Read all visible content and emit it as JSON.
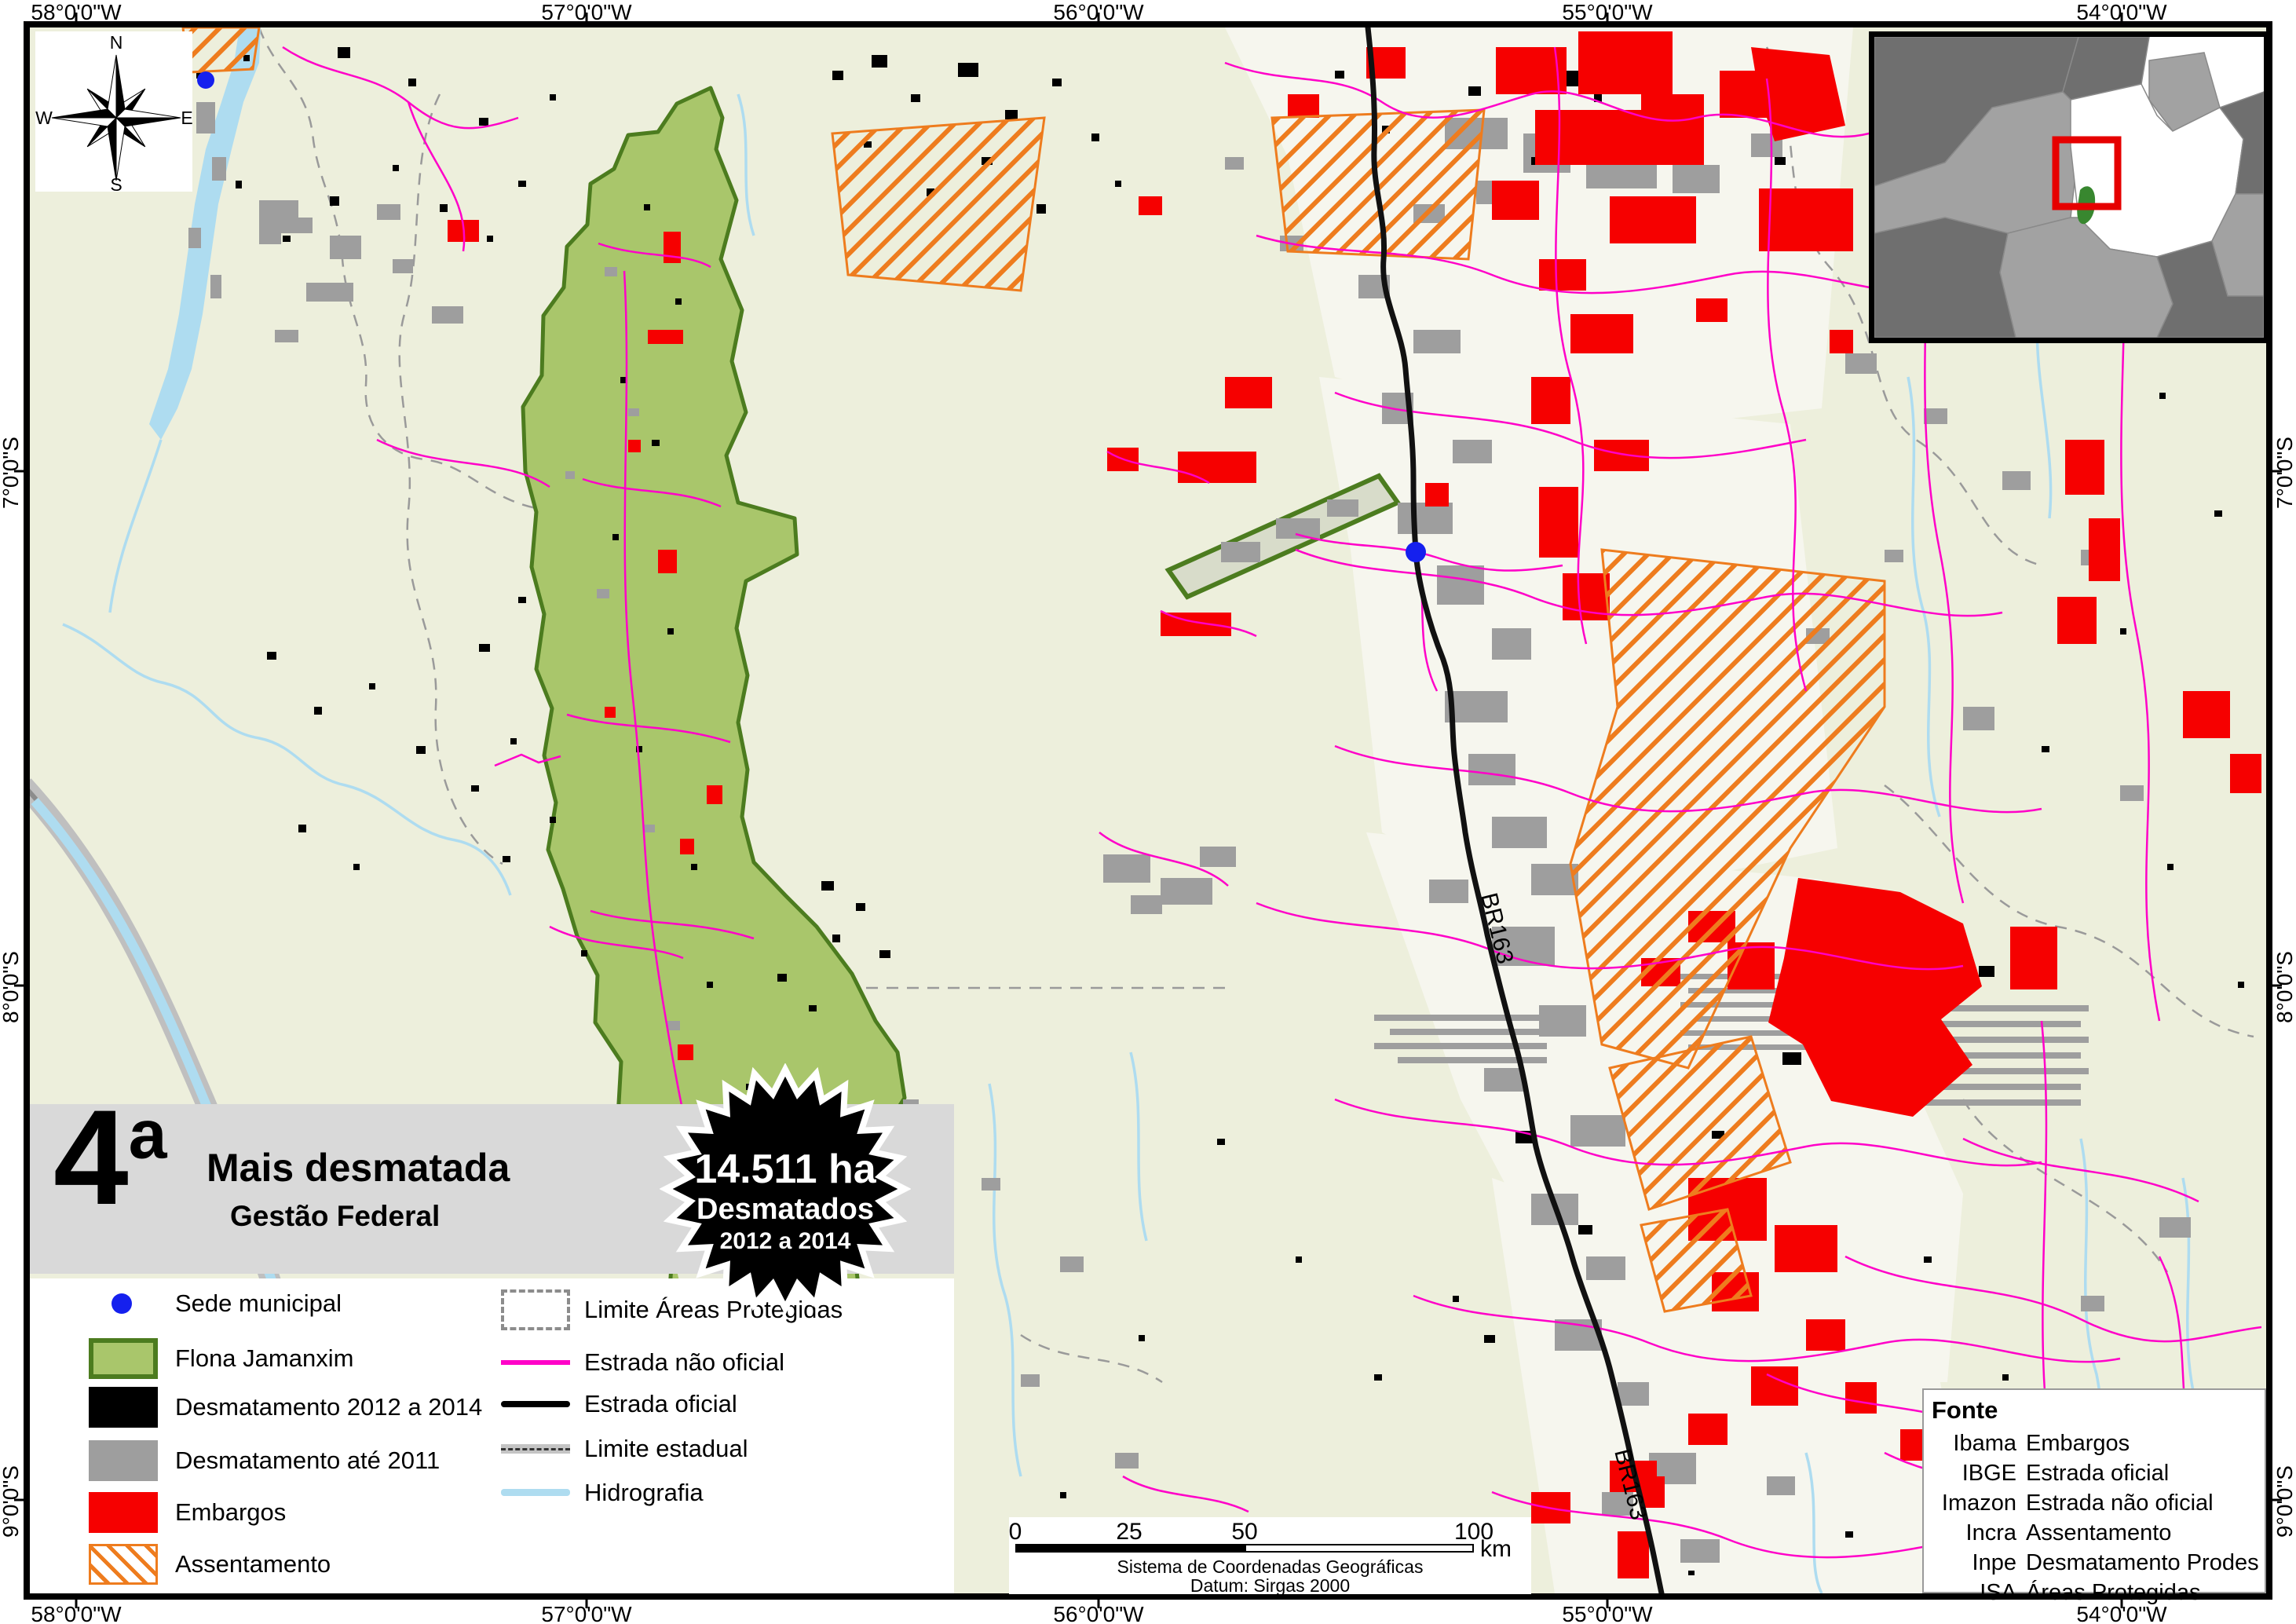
{
  "map": {
    "title_block": {
      "rank": "4",
      "rank_suffix": "a",
      "title": "Mais desmatada",
      "subtitle": "Gestão Federal"
    },
    "badge": {
      "line1": "14.511 ha",
      "line2": "Desmatados",
      "line3": "2012 a 2014"
    },
    "axis": {
      "top": [
        "58°0'0\"W",
        "57°0'0\"W",
        "56°0'0\"W",
        "55°0'0\"W",
        "54°0'0\"W"
      ],
      "bottom": [
        "58°0'0\"W",
        "57°0'0\"W",
        "56°0'0\"W",
        "55°0'0\"W",
        "54°0'0\"W"
      ],
      "left": [
        "7°0'0\"S",
        "8°0'0\"S",
        "9°0'0\"S"
      ],
      "right": [
        "7°0'0\"S",
        "8°0'0\"S",
        "9°0'0\"S"
      ]
    },
    "compass": {
      "n": "N",
      "e": "E",
      "s": "S",
      "w": "W"
    },
    "legend": {
      "column1": [
        {
          "label": "Sede municipal"
        },
        {
          "label": "Flona Jamanxim"
        },
        {
          "label": "Desmatamento 2012 a 2014"
        },
        {
          "label": "Desmatamento até 2011"
        },
        {
          "label": "Embargos"
        },
        {
          "label": "Assentamento"
        }
      ],
      "column2": [
        {
          "label": "Limite Áreas Protegidas"
        },
        {
          "label": "Estrada não oficial"
        },
        {
          "label": "Estrada oficial"
        },
        {
          "label": "Limite estadual"
        },
        {
          "label": "Hidrografia"
        }
      ]
    },
    "scalebar": {
      "ticks": [
        "0",
        "25",
        "50",
        "100"
      ],
      "unit": "km",
      "caption1": "Sistema de Coordenadas Geográficas",
      "caption2": "Datum: Sirgas 2000"
    },
    "fonte": {
      "header": "Fonte",
      "rows": [
        [
          "Ibama",
          "Embargos"
        ],
        [
          "IBGE",
          "Estrada oficial"
        ],
        [
          "Imazon",
          "Estrada não oficial"
        ],
        [
          "Incra",
          "Assentamento"
        ],
        [
          "Inpe",
          "Desmatamento Prodes"
        ],
        [
          "ISA",
          "Áreas Protegidas"
        ]
      ]
    },
    "road_labels": [
      "BR163",
      "BR163"
    ],
    "colors": {
      "background": "#EDEFDC",
      "flona_fill": "#A9C66B",
      "flona_border": "#4C7C1F",
      "desmatamento_2012_2014": "#000000",
      "desmatamento_ate_2011": "#9E9E9E",
      "embargos": "#F60000",
      "assentamento": "#EE7C1E",
      "estrada_nao_oficial": "#FF00C8",
      "estrada_oficial": "#000000",
      "hidrografia": "#AEDCF0",
      "limite_areas_protegidas": "#9A9A9A",
      "sede_municipal": "#1520EE"
    }
  }
}
